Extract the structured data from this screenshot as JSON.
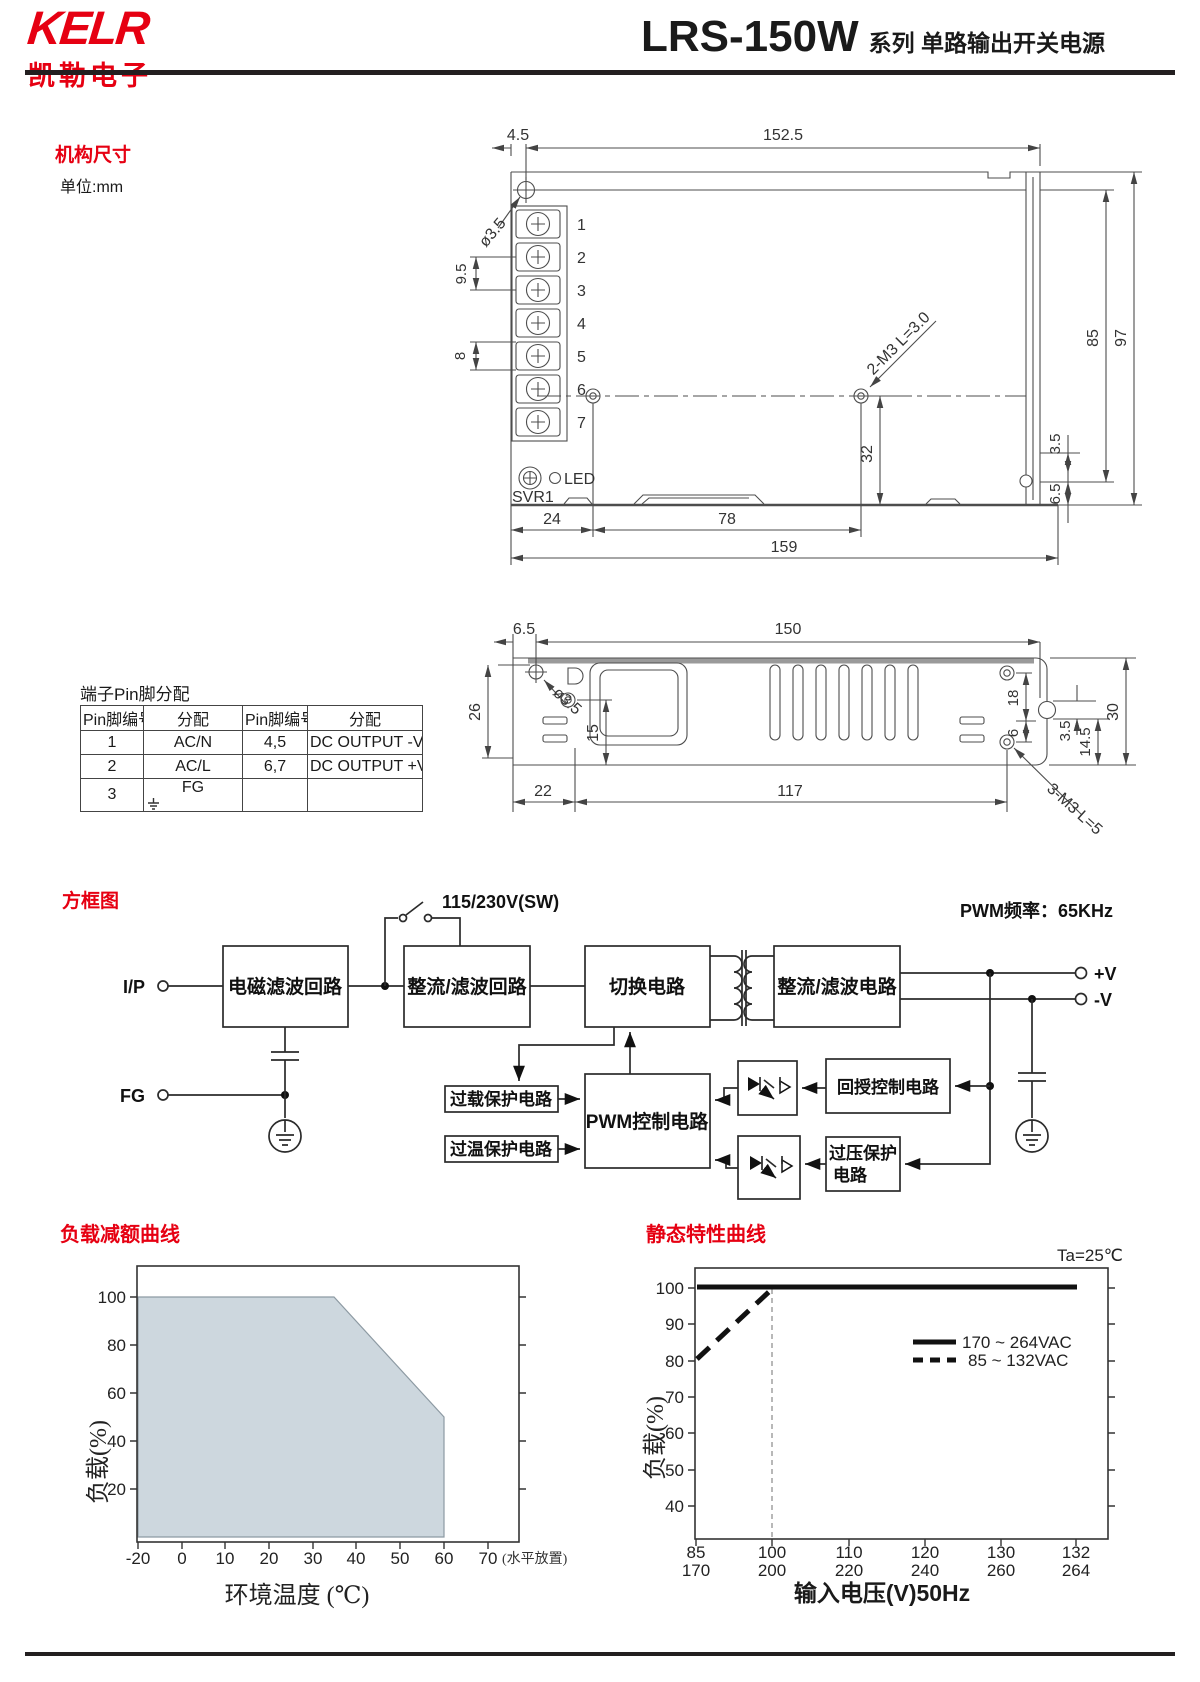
{
  "header": {
    "logo_main": "KELR",
    "logo_sub": "凯勒电子",
    "model": "LRS-150W",
    "series_suffix": "系列 单路输出开关电源"
  },
  "mech": {
    "heading": "机构尺寸",
    "unit_label": "单位:mm",
    "top_view": {
      "pin_numbers": [
        "1",
        "2",
        "3",
        "4",
        "5",
        "6",
        "7"
      ],
      "labels": {
        "hole": "ø3.5",
        "m3": "2-M3 L=3.0",
        "svr": "SVR1",
        "led": "LED"
      },
      "dims": {
        "d4_5": "4.5",
        "d152_5": "152.5",
        "d9_5": "9.5",
        "d8": "8",
        "d32": "32",
        "d85": "85",
        "d97": "97",
        "d3_5": "3.5",
        "d6_5": "6.5",
        "d24": "24",
        "d78": "78",
        "d159": "159"
      }
    },
    "side_view": {
      "labels": {
        "hole": "ø3.5",
        "m3": "3-M3 L=5"
      },
      "dims": {
        "d6_5": "6.5",
        "d150": "150",
        "d26": "26",
        "d15": "15",
        "d22": "22",
        "d117": "117",
        "d18": "18",
        "d6": "6",
        "d3_5": "3.5",
        "d14_5": "14.5",
        "d30": "30"
      }
    }
  },
  "pin_table": {
    "title": "端子Pin脚分配",
    "headers": [
      "Pin脚编号",
      "分配",
      "Pin脚编号",
      "分配"
    ],
    "rows": [
      [
        "1",
        "AC/N",
        "4,5",
        "DC OUTPUT -V"
      ],
      [
        "2",
        "AC/L",
        "6,7",
        "DC OUTPUT +V"
      ],
      [
        "3",
        "FG",
        "",
        ""
      ]
    ]
  },
  "block_diagram": {
    "heading": "方框图",
    "pwm_freq_label": "PWM频率：65KHz",
    "switch_label": "115/230V(SW)",
    "terminals": {
      "input": "I/P",
      "fg": "FG",
      "v_plus": "+V",
      "v_minus": "-V"
    },
    "blocks": {
      "emi": "电磁滤波回路",
      "rectifier_in": "整流/滤波回路",
      "switching": "切换电路",
      "rectifier_out": "整流/滤波电路",
      "overload": "过载保护电路",
      "overtemp": "过温保护电路",
      "pwm": "PWM控制电路",
      "feedback": "回授控制电路",
      "ovp_line1": "过压保护",
      "ovp_line2": "电路"
    }
  },
  "chart_data": [
    {
      "type": "area",
      "title": "负载减额曲线",
      "xlabel": "环境温度 (℃)",
      "ylabel": "负载(%)",
      "x_note": "(水平放置)",
      "xticks": [
        "-20",
        "0",
        "10",
        "20",
        "30",
        "40",
        "50",
        "60",
        "70"
      ],
      "yticks": [
        "100",
        "80",
        "60",
        "40",
        "20"
      ],
      "xlim": [
        -20,
        78
      ],
      "ylim": [
        0,
        113
      ],
      "grid": false,
      "points": [
        [
          -20,
          100
        ],
        [
          35,
          100
        ],
        [
          60,
          50
        ],
        [
          60,
          0
        ]
      ],
      "fill_color": "#cdd7de"
    },
    {
      "type": "line",
      "title": "静态特性曲线",
      "annotation": "Ta=25℃",
      "xlabel": "输入电压(V)50Hz",
      "ylabel": "负载(%)",
      "yticks": [
        "100",
        "90",
        "80",
        "70",
        "60",
        "50",
        "40"
      ],
      "xticks_primary": [
        "85",
        "100",
        "110",
        "120",
        "130",
        "132"
      ],
      "xticks_secondary": [
        "170",
        "200",
        "220",
        "240",
        "260",
        "264"
      ],
      "ylim": [
        30,
        105
      ],
      "grid": false,
      "legend_position": "upper right",
      "series": [
        {
          "name": "170 ~ 264VAC",
          "style": "solid",
          "points": [
            [
              85,
              100
            ],
            [
              132,
              100
            ]
          ]
        },
        {
          "name": "85 ~ 132VAC",
          "style": "dashed",
          "points": [
            [
              85,
              80
            ],
            [
              100,
              100
            ],
            [
              132,
              100
            ]
          ]
        }
      ]
    }
  ]
}
